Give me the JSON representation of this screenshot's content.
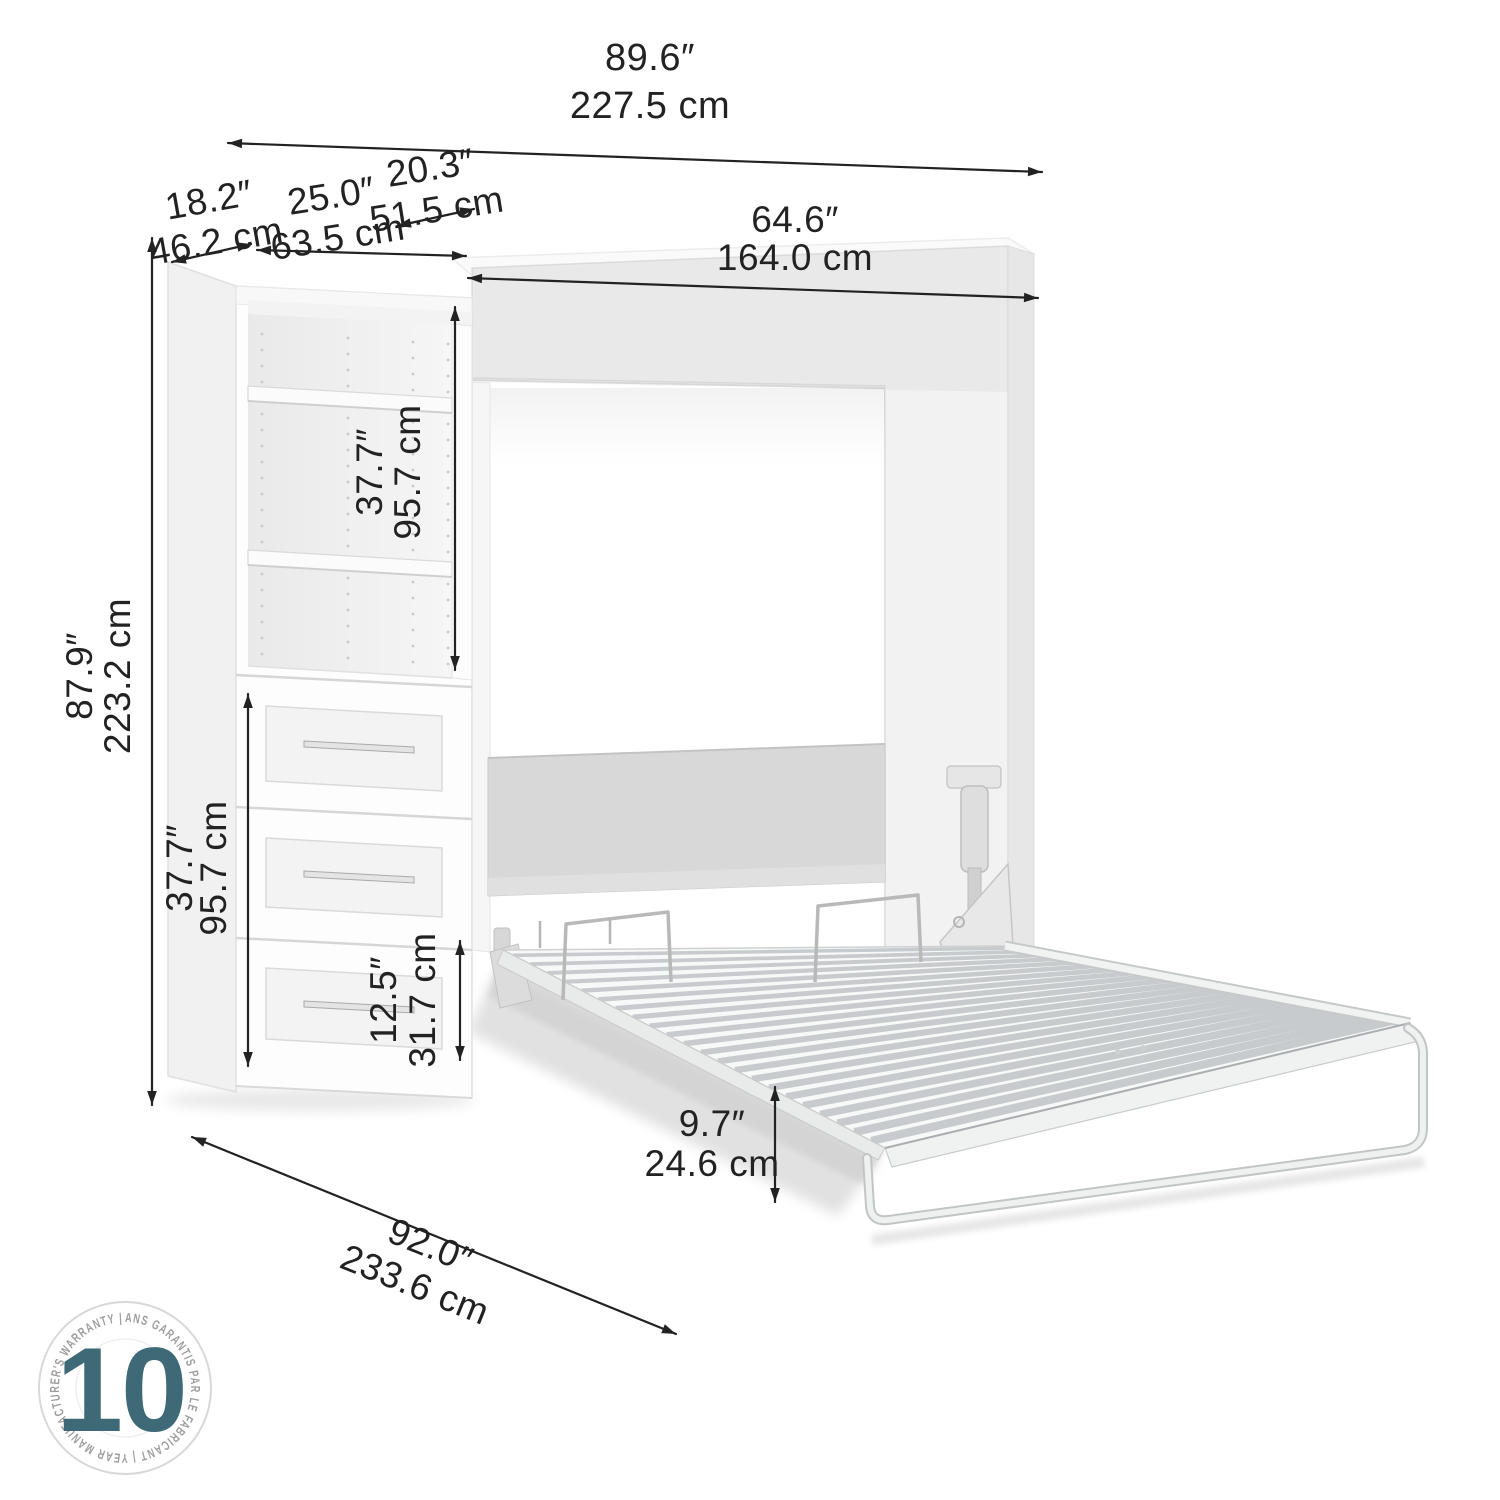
{
  "colors": {
    "dimension_line": "#222222",
    "badge_accent": "#3d6a76",
    "badge_ring_text": "#9e9e9e",
    "furniture_edge": "#dddddd",
    "headboard_gray": "#d8d8d8"
  },
  "dimensions": {
    "overall_width": {
      "in": "89.6″",
      "cm": "227.5 cm"
    },
    "opening_width": {
      "in": "64.6″",
      "cm": "164.0 cm"
    },
    "top_depth": {
      "in": "20.3″",
      "cm": "51.5 cm"
    },
    "side_depth": {
      "in": "18.2″",
      "cm": "46.2 cm"
    },
    "shelf_width": {
      "in": "25.0″",
      "cm": "63.5 cm"
    },
    "overall_height": {
      "in": "87.9″",
      "cm": "223.2 cm"
    },
    "shelf_section_height": {
      "in": "37.7″",
      "cm": "95.7 cm"
    },
    "drawer_section_height": {
      "in": "37.7″",
      "cm": "95.7 cm"
    },
    "bottom_drawer_height": {
      "in": "12.5″",
      "cm": "31.7 cm"
    },
    "floor_clearance": {
      "in": "9.7″",
      "cm": "24.6 cm"
    },
    "total_depth_open": {
      "in": "92.0″",
      "cm": "233.6 cm"
    }
  },
  "warranty": {
    "years": "10",
    "ring_text": "ANS GARANTIS PAR LE FABRICANT  |  YEAR MANUFACTURER'S WARRANTY  |"
  }
}
